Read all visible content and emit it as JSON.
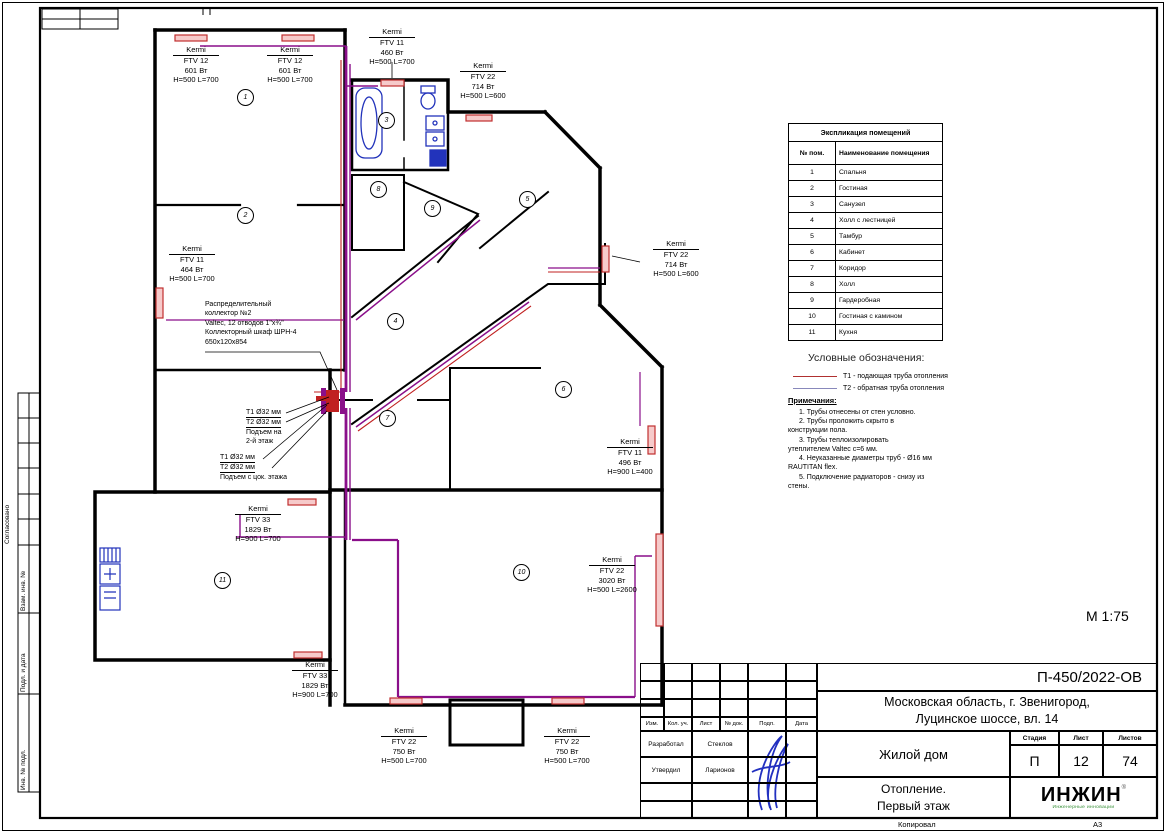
{
  "sheet": {
    "scale": "М 1:75",
    "footer": {
      "copied": "Копировал",
      "format": "А3"
    }
  },
  "side_strip": {
    "approved": "Согласовано",
    "sections": [
      "Взам. инв. №",
      "Подл. и дата",
      "Инв. № подл."
    ]
  },
  "explication": {
    "title": "Экспликация помещений",
    "col_num": "№ пом.",
    "col_name": "Наименование помещения",
    "rows": [
      {
        "num": "1",
        "name": "Спальня"
      },
      {
        "num": "2",
        "name": "Гостиная"
      },
      {
        "num": "3",
        "name": "Санузел"
      },
      {
        "num": "4",
        "name": "Холл с лестницей"
      },
      {
        "num": "5",
        "name": "Тамбур"
      },
      {
        "num": "6",
        "name": "Кабинет"
      },
      {
        "num": "7",
        "name": "Коридор"
      },
      {
        "num": "8",
        "name": "Холл"
      },
      {
        "num": "9",
        "name": "Гардеробная"
      },
      {
        "num": "10",
        "name": "Гостиная с камином"
      },
      {
        "num": "11",
        "name": "Кухня"
      }
    ]
  },
  "legend": {
    "title": "Условные обозначения:",
    "items": [
      {
        "label": "Т1 - подающая труба отопления",
        "color": "#b03030"
      },
      {
        "label": "Т2 - обратная труба отопления",
        "color": "#8888bb"
      }
    ]
  },
  "notes": {
    "title": "Примечания:",
    "items": [
      [
        "1.    Трубы отнесены от стен условно."
      ],
      [
        "2.    Трубы проложить скрыто в",
        "конструкции пола."
      ],
      [
        "3.    Трубы теплоизолировать",
        "утеплителем Valtec с=6 мм."
      ],
      [
        "4.    Неуказанные диаметры труб - Ø16 мм",
        "RAUTITAN flex."
      ],
      [
        "5.    Подключение радиаторов - снизу из",
        "стены."
      ]
    ]
  },
  "collector_note": {
    "lines": [
      "Распределительный",
      "коллектор №2",
      "Valtec, 12 отводов 1\"х¾\"",
      "Коллекторный шкаф ШРН-4",
      "650х120х854"
    ]
  },
  "riser_labels": [
    {
      "x": 246,
      "y": 408,
      "lines": [
        "Т1 Ø32 мм",
        "Т2 Ø32 мм",
        "Подъем на",
        "2-й этаж"
      ],
      "underlined": 2
    },
    {
      "x": 220,
      "y": 453,
      "lines": [
        "Т1 Ø32 мм",
        "Т2 Ø32 мм",
        "Подъем с цок. этажа"
      ],
      "underlined": 2
    }
  ],
  "radiators": [
    {
      "brand": "Kermi",
      "model": "FTV 12",
      "power": "601 Вт",
      "size": "H=500 L=700",
      "x": 196,
      "y": 45
    },
    {
      "brand": "Kermi",
      "model": "FTV 12",
      "power": "601 Вт",
      "size": "H=500 L=700",
      "x": 290,
      "y": 45
    },
    {
      "brand": "Kermi",
      "model": "FTV 11",
      "power": "460 Вт",
      "size": "H=500 L=700",
      "x": 392,
      "y": 27
    },
    {
      "brand": "Kermi",
      "model": "FTV 22",
      "power": "714 Вт",
      "size": "H=500 L=600",
      "x": 483,
      "y": 61
    },
    {
      "brand": "Kermi",
      "model": "FTV 22",
      "power": "714 Вт",
      "size": "H=500 L=600",
      "x": 676,
      "y": 239
    },
    {
      "brand": "Kermi",
      "model": "FTV 11",
      "power": "464 Вт",
      "size": "H=500 L=700",
      "x": 192,
      "y": 244
    },
    {
      "brand": "Kermi",
      "model": "FTV 11",
      "power": "496 Вт",
      "size": "H=900 L=400",
      "x": 630,
      "y": 437
    },
    {
      "brand": "Kermi",
      "model": "FTV 33",
      "power": "1829 Вт",
      "size": "H=900 L=700",
      "x": 258,
      "y": 504
    },
    {
      "brand": "Kermi",
      "model": "FTV 22",
      "power": "3020 Вт",
      "size": "H=500 L=2600",
      "x": 612,
      "y": 555
    },
    {
      "brand": "Kermi",
      "model": "FTV 33",
      "power": "1829 Вт",
      "size": "H=900 L=700",
      "x": 315,
      "y": 660
    },
    {
      "brand": "Kermi",
      "model": "FTV 22",
      "power": "750 Вт",
      "size": "H=500 L=700",
      "x": 404,
      "y": 726
    },
    {
      "brand": "Kermi",
      "model": "FTV 22",
      "power": "750 Вт",
      "size": "H=500 L=700",
      "x": 567,
      "y": 726
    }
  ],
  "rooms": [
    {
      "num": "1",
      "x": 245,
      "y": 97
    },
    {
      "num": "2",
      "x": 245,
      "y": 215
    },
    {
      "num": "3",
      "x": 386,
      "y": 120
    },
    {
      "num": "4",
      "x": 395,
      "y": 321
    },
    {
      "num": "5",
      "x": 527,
      "y": 199
    },
    {
      "num": "6",
      "x": 563,
      "y": 389
    },
    {
      "num": "7",
      "x": 387,
      "y": 418
    },
    {
      "num": "8",
      "x": 378,
      "y": 189
    },
    {
      "num": "9",
      "x": 432,
      "y": 208
    },
    {
      "num": "10",
      "x": 521,
      "y": 572
    },
    {
      "num": "11",
      "x": 222,
      "y": 580
    }
  ],
  "title_block": {
    "doc_number": "П-450/2022-ОВ",
    "address": [
      "Московская область, г. Звенигород,",
      "Луцинское шоссе, вл. 14"
    ],
    "object_name": "Жилой дом",
    "drawing_title": [
      "Отопление.",
      "Первый этаж"
    ],
    "stage_label": "Стадия",
    "sheet_label": "Лист",
    "sheets_label": "Листов",
    "stage": "П",
    "sheet_num": "12",
    "sheets_total": "74",
    "header_cols": [
      "Изм.",
      "Кол. уч.",
      "Лист",
      "№ док.",
      "Подп.",
      "Дата"
    ],
    "roles": [
      {
        "role": "Разработал",
        "name": "Стеклов"
      },
      {
        "role": "Утвердил",
        "name": "Ларионов"
      }
    ],
    "logo": {
      "text": "ИНЖИН",
      "reg": "®",
      "subtitle": "Инженерные инновации"
    }
  },
  "colors": {
    "supply_pipe": "#c02020",
    "return_pipe": "#8888bb",
    "main_pipe": "#8a0f8a",
    "radiator_fill": "#f6caca",
    "radiator_stroke": "#c03030",
    "fixtures": "#2233bb",
    "signature": "#2230c0",
    "logo_green": "#2e8b2e"
  }
}
